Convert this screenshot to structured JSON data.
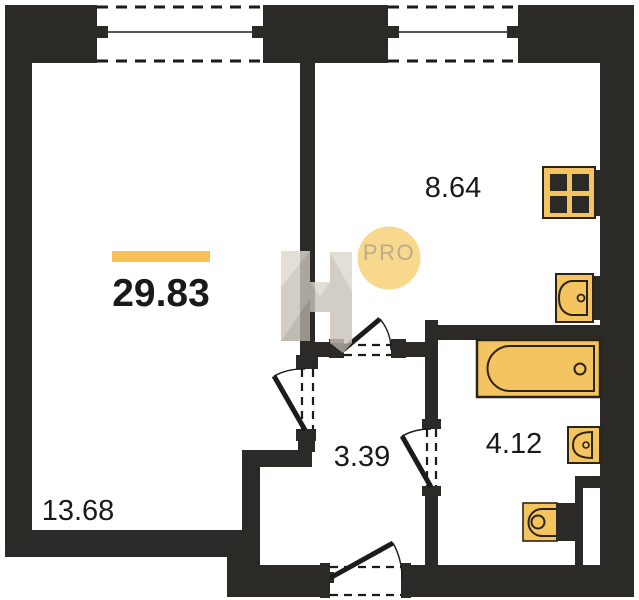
{
  "plan": {
    "total_area_label": "29.83",
    "rooms": [
      {
        "name": "living-room",
        "area_label": "13.68"
      },
      {
        "name": "kitchen",
        "area_label": "8.64"
      },
      {
        "name": "bathroom",
        "area_label": "4.12"
      },
      {
        "name": "hallway",
        "area_label": "3.39"
      }
    ]
  },
  "watermark": {
    "badge_text": "PRO"
  },
  "colors": {
    "background": "#ffffff",
    "wall": "#2b2a27",
    "line": "#1c1b1a",
    "room_fill": "#ffffff",
    "label_color": "#1a1a1a",
    "fixture_fill": "#f4c460",
    "fixture_stroke": "#2b2416",
    "accent_bar": "#f6c257",
    "badge_fill": "#f8d88c",
    "badge_text": "#b9ab8e",
    "watermark_base": "#c9c3b9",
    "watermark_light": "#ddd8d0",
    "watermark_dark": "#b2aca2"
  }
}
